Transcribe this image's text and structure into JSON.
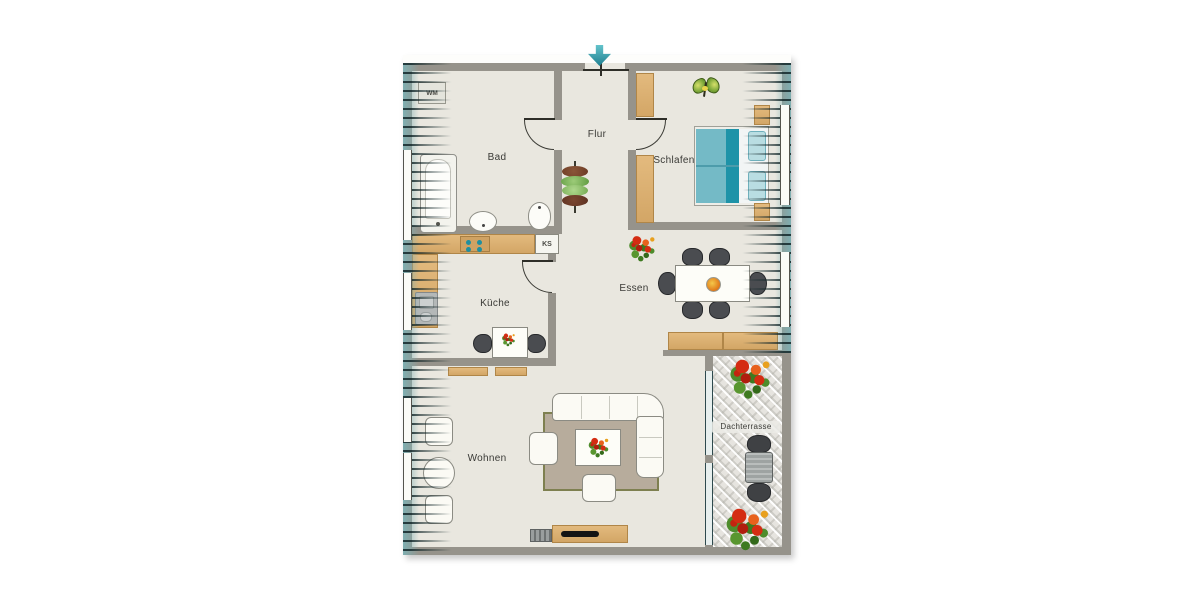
{
  "plan": {
    "type": "apartment-floorplan",
    "rooms": [
      {
        "id": "bad",
        "label": "Bad"
      },
      {
        "id": "flur",
        "label": "Flur"
      },
      {
        "id": "schlafen",
        "label": "Schlafen"
      },
      {
        "id": "kueche",
        "label": "Küche"
      },
      {
        "id": "essen",
        "label": "Essen"
      },
      {
        "id": "wohnen",
        "label": "Wohnen"
      },
      {
        "id": "dachterrasse",
        "label": "Dachterrasse"
      }
    ],
    "appliances": {
      "washing_machine": "WM",
      "fridge": "KS"
    },
    "icons": [
      "entrance-arrow-icon",
      "butterfly-icon",
      "plant-icon",
      "flower-icon"
    ],
    "colors": {
      "wall": "#96938b",
      "floor": "#e9e7df",
      "wood": "#ddb174",
      "roof_slope_teal": "#7db0b3",
      "entrance_arrow": "#3ba0ae",
      "bed_teal": "#74bac6",
      "bed_teal_dark": "#1e93a8",
      "chair_dark": "#4a4c50",
      "rug": "#b7ac9c",
      "flower_red": "#d42c12",
      "leaf_green": "#4e8c2c"
    }
  }
}
